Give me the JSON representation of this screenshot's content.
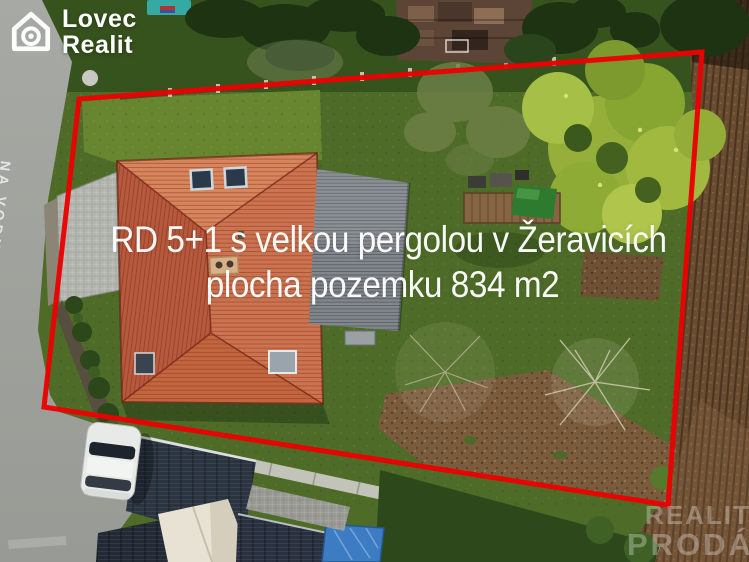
{
  "branding": {
    "name_line1": "Lovec",
    "name_line2": "Realit"
  },
  "listing": {
    "title": "RD 5+1 s velkou pergolou v Žeravicích",
    "subtitle": "plocha pozemku 834 m2"
  },
  "road_marking": {
    "text": "NA VODU SI VYBIJ"
  },
  "watermark": {
    "line1": "REALIT",
    "line2": "PRODÁ"
  },
  "boundary": {
    "points": "79,99 702,52 668,505 44,407",
    "color": "#ea0202"
  },
  "palette": {
    "boundary_red": "#ea0202",
    "roof_orange": "#cc7450",
    "pergola_gray": "#82878d",
    "lawn_green": "#4e6c28",
    "field_brown": "#6a4c31",
    "tarp_blue": "#3d7cc2"
  }
}
